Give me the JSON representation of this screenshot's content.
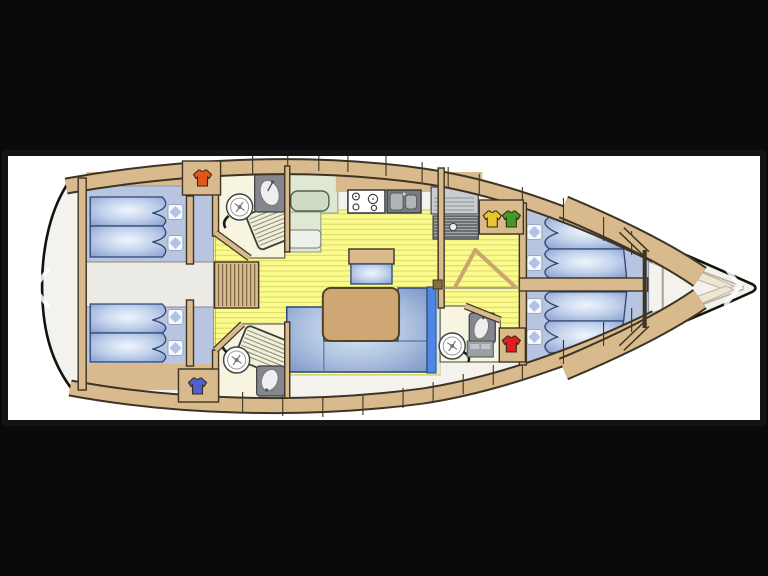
{
  "viewer": {
    "type": "image-carousel-lightbox",
    "content": "sailing-yacht-interior-floorplan",
    "nav": {
      "prev_icon": "chevron-left-icon",
      "next_icon": "chevron-right-icon"
    }
  },
  "palette": {
    "bg": "#0a0a0a",
    "frame": "#141414",
    "panel": "#ffffff",
    "arrow": "#ffffff",
    "hull_fill": "#f3f2ec",
    "hull_stroke": "#15120e",
    "wood": "#d9ba8c",
    "wood_stroke": "#3d3425",
    "floor": "#fafa8e",
    "plank": "#d9d960",
    "cream": "#f7f4df",
    "green": "#dfe8d5",
    "green_dark": "#d0dcc6",
    "cabin_floor": "#b7c5e0",
    "engine": "#eceae4",
    "gray_dark": "#84878d",
    "matt_stroke": "#2e4674",
    "sofa_edge": "#4d86e6",
    "sofa_light": "#d6e6f6",
    "pillow_diamond": "#a9bce2",
    "shirt_orange": "#e2551c",
    "shirt_blue": "#4f5fd0",
    "shirt_yellow": "#e6c72e",
    "shirt_green": "#3f9b2a",
    "shirt_red": "#df1f1f"
  },
  "plan": {
    "bow_direction": "right",
    "aft_double_cabins": 2,
    "forward_double_cabins": 2,
    "bathrooms": 3,
    "galley": [
      "stove-4-burners",
      "double-sink",
      "fridge",
      "companionway-steps"
    ],
    "salon": [
      "u-shaped-sofa",
      "dinette-table",
      "stool-seat"
    ],
    "wardrobe_markers": [
      {
        "id": "aft-port",
        "icon": "tshirt-icon",
        "color_key": "shirt_orange"
      },
      {
        "id": "aft-starboard",
        "icon": "tshirt-icon",
        "color_key": "shirt_blue"
      },
      {
        "id": "forward-port-1",
        "icon": "tshirt-icon",
        "color_key": "shirt_yellow"
      },
      {
        "id": "forward-port-2",
        "icon": "tshirt-icon",
        "color_key": "shirt_green"
      },
      {
        "id": "forward-starboard",
        "icon": "tshirt-icon",
        "color_key": "shirt_red"
      }
    ]
  }
}
